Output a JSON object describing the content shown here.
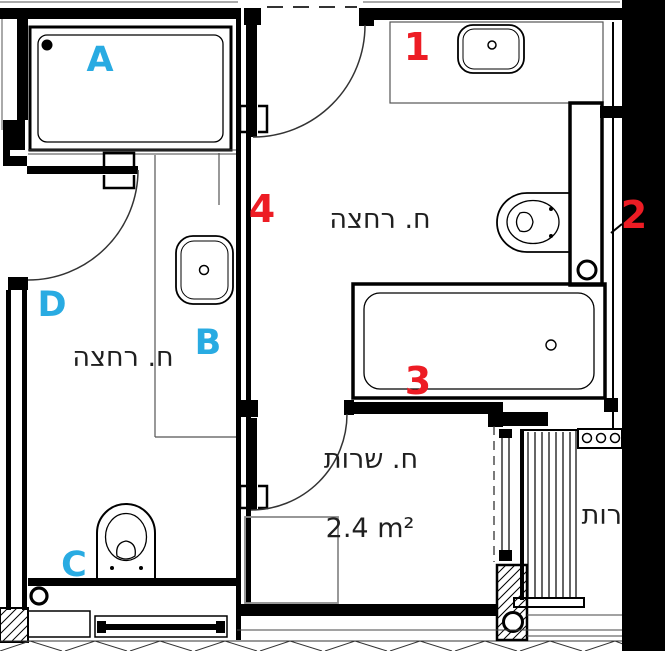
{
  "plan": {
    "colors": {
      "marker_red": "#ed1c24",
      "marker_blue": "#29abe2",
      "wall": "#000000",
      "text": "#1f1f1f",
      "appliance_gray": "#8c8c8c"
    },
    "rooms": [
      {
        "id": "bathroom-main",
        "label": "ח. רחצה"
      },
      {
        "id": "bathroom-secondary",
        "label": "ח. רחצה"
      },
      {
        "id": "service-room",
        "label": "ח. שרות",
        "area": "2.4 m²"
      },
      {
        "id": "neighbor-room-partial",
        "label": "רות"
      }
    ],
    "red_markers": [
      {
        "label": "1"
      },
      {
        "label": "2"
      },
      {
        "label": "3"
      },
      {
        "label": "4"
      }
    ],
    "blue_markers": [
      {
        "label": "A"
      },
      {
        "label": "B"
      },
      {
        "label": "C"
      },
      {
        "label": "D"
      }
    ]
  }
}
